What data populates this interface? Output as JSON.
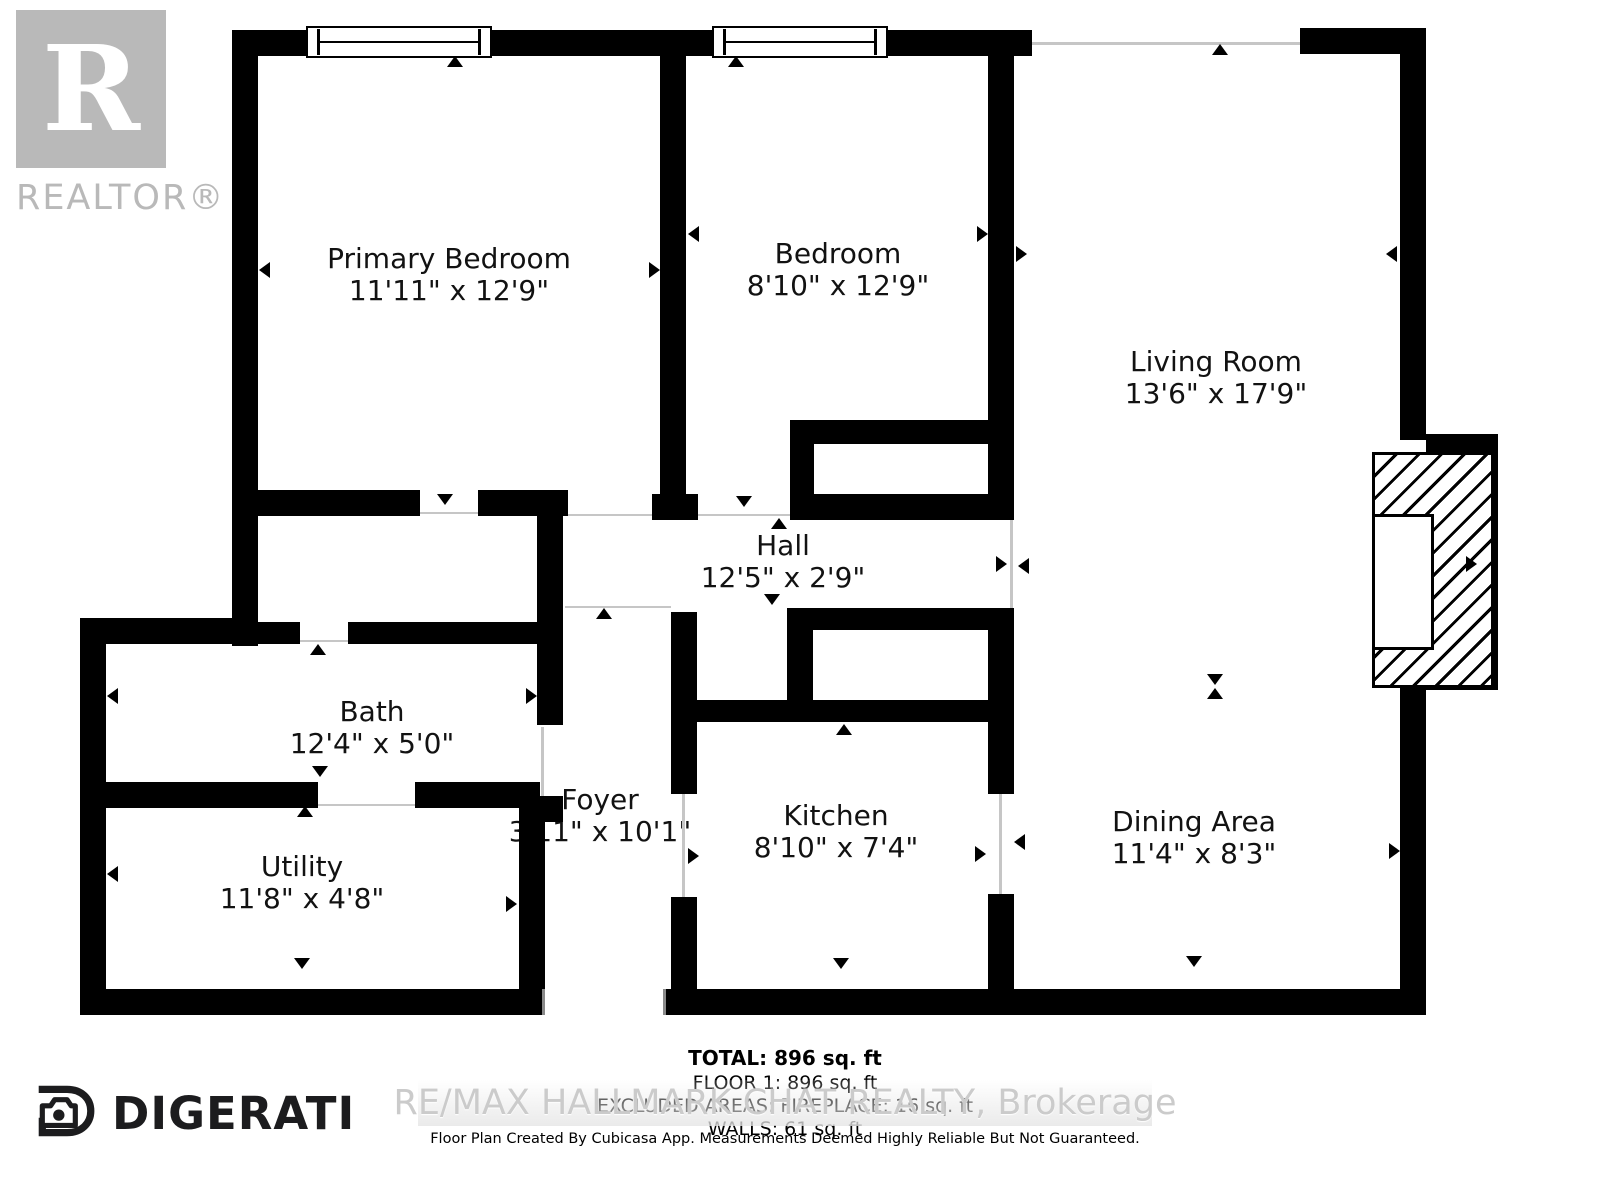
{
  "branding": {
    "realtor_monogram": "R",
    "realtor_label": "REALTOR®",
    "digerati_label": "DIGERATI"
  },
  "rooms": [
    {
      "name": "Primary Bedroom",
      "dims": "11'11\" x 12'9\""
    },
    {
      "name": "Bedroom",
      "dims": "8'10\" x 12'9\""
    },
    {
      "name": "Living Room",
      "dims": "13'6\" x 17'9\""
    },
    {
      "name": "Hall",
      "dims": "12'5\" x 2'9\""
    },
    {
      "name": "Bath",
      "dims": "12'4\" x 5'0\""
    },
    {
      "name": "Foyer",
      "dims": "3'11\" x 10'1\""
    },
    {
      "name": "Kitchen",
      "dims": "8'10\" x 7'4\""
    },
    {
      "name": "Utility",
      "dims": "11'8\" x 4'8\""
    },
    {
      "name": "Dining Area",
      "dims": "11'4\" x 8'3\""
    }
  ],
  "summary": {
    "total": "TOTAL: 896 sq. ft",
    "floor1": "FLOOR 1: 896 sq. ft",
    "excluded": "EXCLUDED AREAS: FIREPLACE: 16 sq. ft",
    "walls": "WALLS: 61 sq. ft"
  },
  "watermark": "RE/MAX HALLMARK CHAT REALTY, Brokerage",
  "disclaimer": "Floor Plan Created By Cubicasa App. Measurements Deemed Highly Reliable But Not Guaranteed.",
  "colors": {
    "wall": "#000000",
    "logo_grey": "#b9b9b9",
    "watermark_grey": "#cbcbcb"
  }
}
